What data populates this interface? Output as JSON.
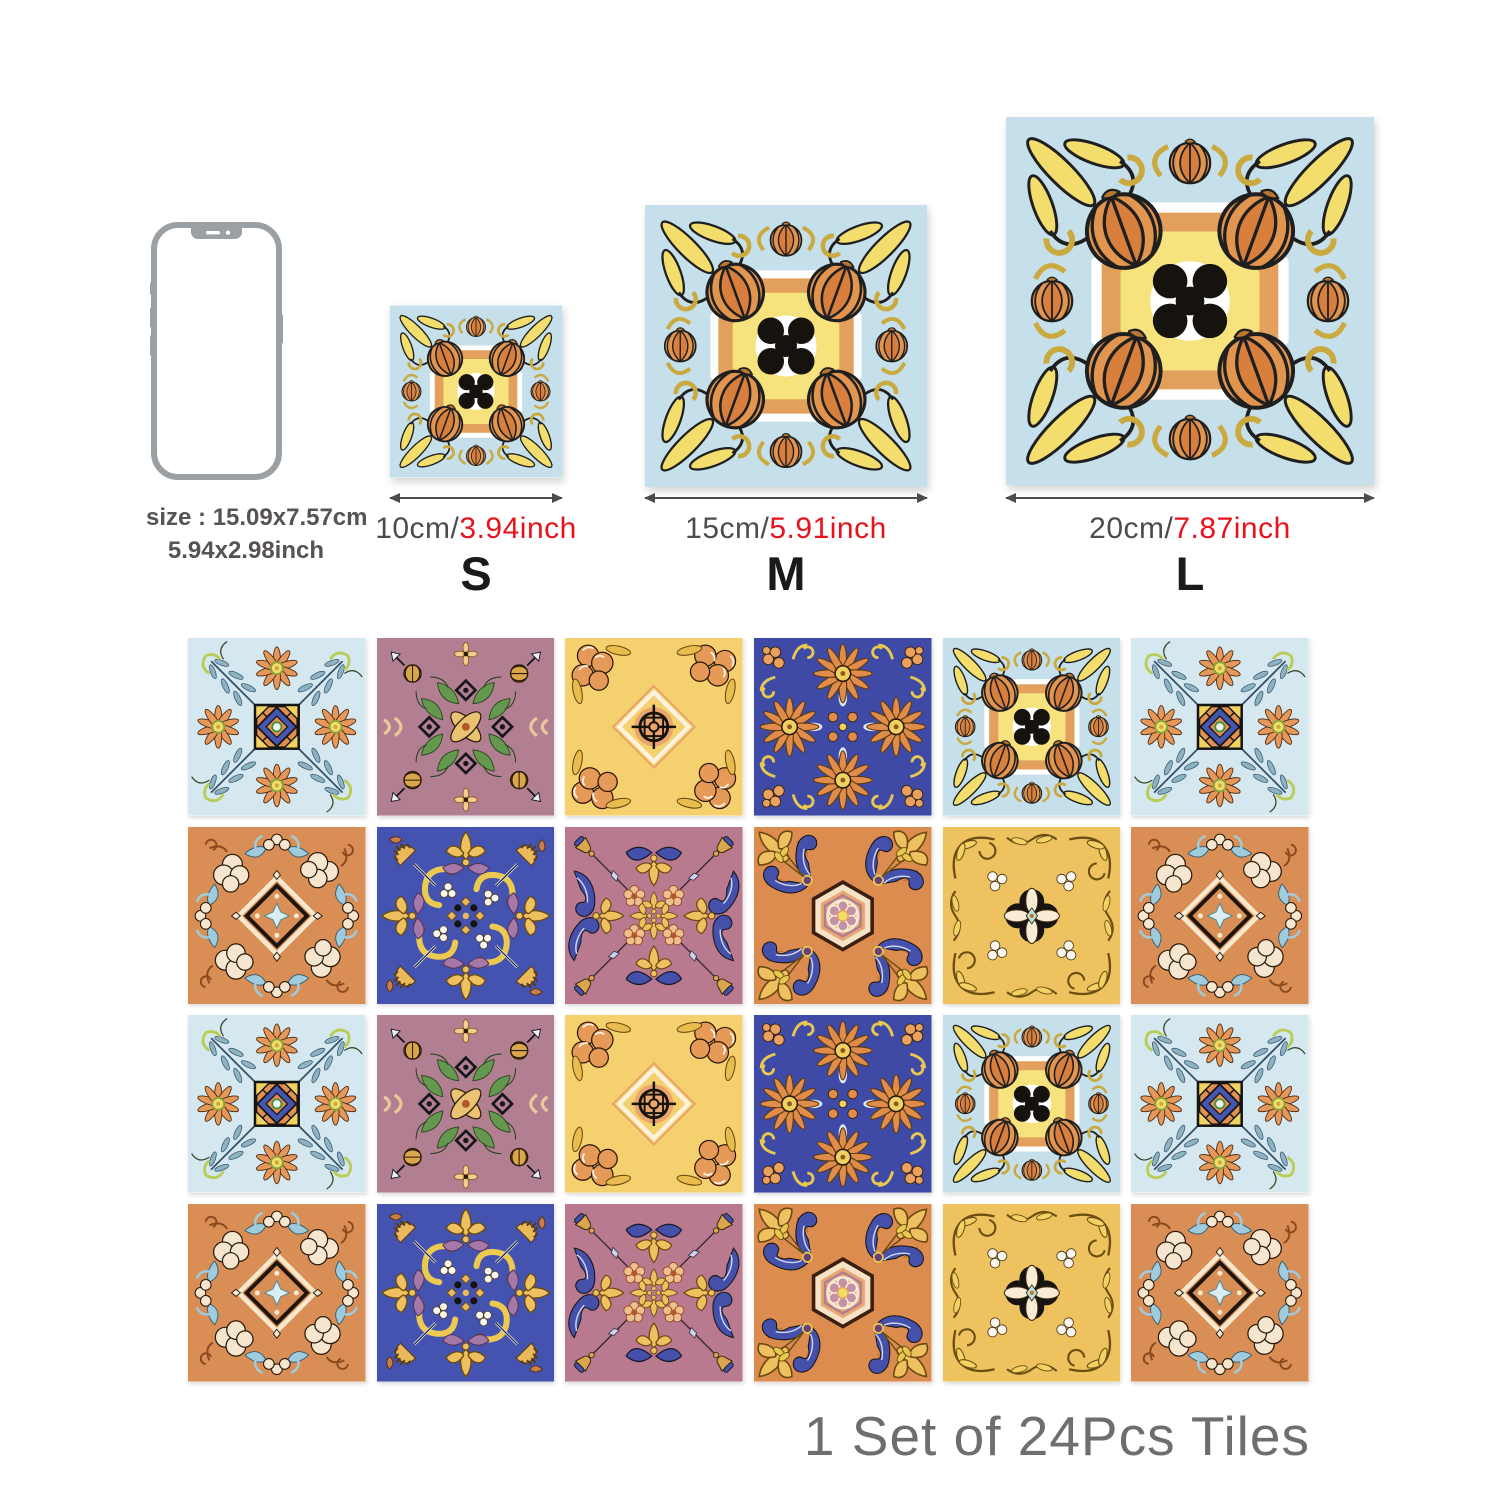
{
  "phone": {
    "name": "smartphone-size-reference",
    "size_line_1": "size : 15.09x7.57cm",
    "size_line_2": "5.94x2.98inch"
  },
  "sizes": [
    {
      "label": "S",
      "cm": "10cm/",
      "inch": "3.94inch"
    },
    {
      "label": "M",
      "cm": "15cm/",
      "inch": "5.91inch"
    },
    {
      "label": "L",
      "cm": "20cm/",
      "inch": "7.87inch"
    }
  ],
  "display_tile_design": "E",
  "footer": {
    "text": "1 Set of 24Pcs Tiles"
  },
  "grid": {
    "tile_count": 24,
    "rows": [
      [
        "A",
        "B",
        "C",
        "D",
        "E",
        "A"
      ],
      [
        "F",
        "G",
        "H",
        "I",
        "J",
        "F"
      ],
      [
        "A",
        "B",
        "C",
        "D",
        "E",
        "A"
      ],
      [
        "F",
        "G",
        "H",
        "I",
        "J",
        "F"
      ]
    ]
  },
  "designs": {
    "A": {
      "name": "light-blue-daisy-square",
      "bg": "#d6e8ef"
    },
    "B": {
      "name": "mauve-gold-knot",
      "bg": "#b27e92"
    },
    "C": {
      "name": "gold-peony-compass",
      "bg": "#f5d06e"
    },
    "D": {
      "name": "royal-blue-sunflower",
      "bg": "#3e4aa5"
    },
    "E": {
      "name": "light-blue-pumpkin-medallion",
      "bg": "#c5e0ea"
    },
    "F": {
      "name": "terracotta-cream-diamond",
      "bg": "#d98e55"
    },
    "G": {
      "name": "royal-blue-gold-scroll",
      "bg": "#4553b0"
    },
    "H": {
      "name": "mauve-blue-paisley",
      "bg": "#b9798e"
    },
    "I": {
      "name": "terracotta-hexagon-rosette",
      "bg": "#dd8c50"
    },
    "J": {
      "name": "gold-quatrefoil-vine",
      "bg": "#eec25f"
    }
  },
  "colors": {
    "dimension_gray": "#4c4c4c",
    "inch_red": "#e8121c",
    "letter_black": "#1a1a1a",
    "footer_gray": "#6e6e6e",
    "phone_outline": "#9aa0a3",
    "arrow_gray": "#4c4c4c"
  }
}
